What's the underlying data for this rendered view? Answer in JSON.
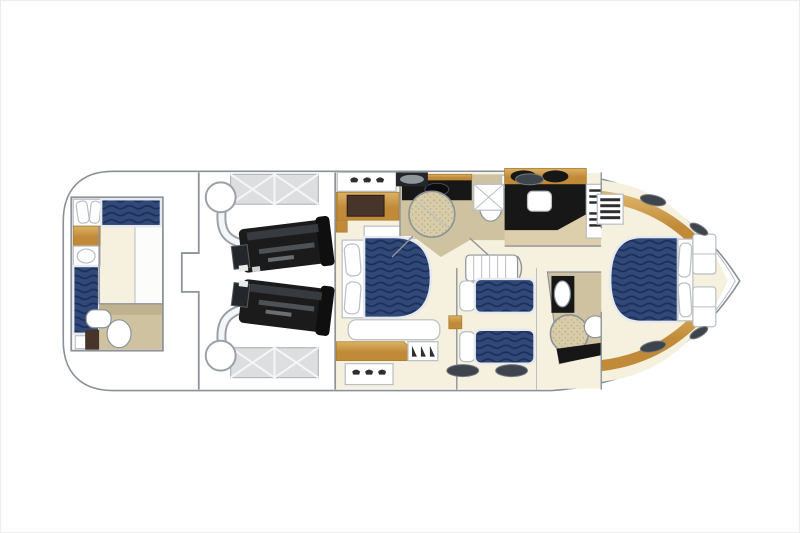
{
  "diagram": {
    "type": "floorplan",
    "subject": "motor-yacht lower-deck accommodation plan, bow pointing right",
    "rooms": [
      "aft-crew-cabin",
      "crew-bathroom",
      "engine-room",
      "master-cabin",
      "master-bathroom",
      "galley",
      "twin-guest-cabin",
      "guest-bathroom",
      "bow-vip-cabin"
    ],
    "features": [
      "crew-single-berth-athwartships",
      "crew-single-berth-fore-aft",
      "crew-toilet",
      "crew-sink",
      "port-engine",
      "starboard-engine",
      "port-muffler",
      "starboard-muffler",
      "engine-room-hatch-port",
      "engine-room-hatch-starboard",
      "master-double-bed",
      "master-tv-dresser",
      "master-shower",
      "master-sink",
      "galley-cooktop-burners",
      "galley-sink",
      "galley-fridge",
      "companionway-steps",
      "corridor-stairs",
      "twin-bed-forward",
      "twin-bed-aft",
      "guest-shower",
      "guest-sink",
      "guest-toilet",
      "vip-island-double-bed",
      "vip-shelf-units",
      "hull-window-ovals",
      "deck-vents"
    ]
  },
  "palette": {
    "hull-stroke": "#8a9097",
    "wall": "#8d939a",
    "wall-light": "#b8bec4",
    "cream": "#f6f0de",
    "tan": "#cfc2a0",
    "tan-dark": "#bfb28d",
    "wood-1": "#dcb267",
    "wood-2": "#c08a38",
    "wood-edge": "#a87f2f",
    "dark-wood": "#47342a",
    "black": "#171717",
    "engine": "#1b1b1b",
    "mattress-navy": "#30497a",
    "mattress-wave": "#1e2f55",
    "mattress-edge": "#e6e9ee",
    "hatch-bg": "#dcdee0",
    "hatch-edge": "#b4b8bc",
    "hatch-line": "#f5f6f7",
    "window": "#3e444b",
    "window-edge": "#74797f",
    "pipe-edge": "#9aa1a8",
    "vent": "#2e2e2e",
    "speckle-bg": "#d8cca9",
    "speckle-dot": "#b3a67e"
  }
}
